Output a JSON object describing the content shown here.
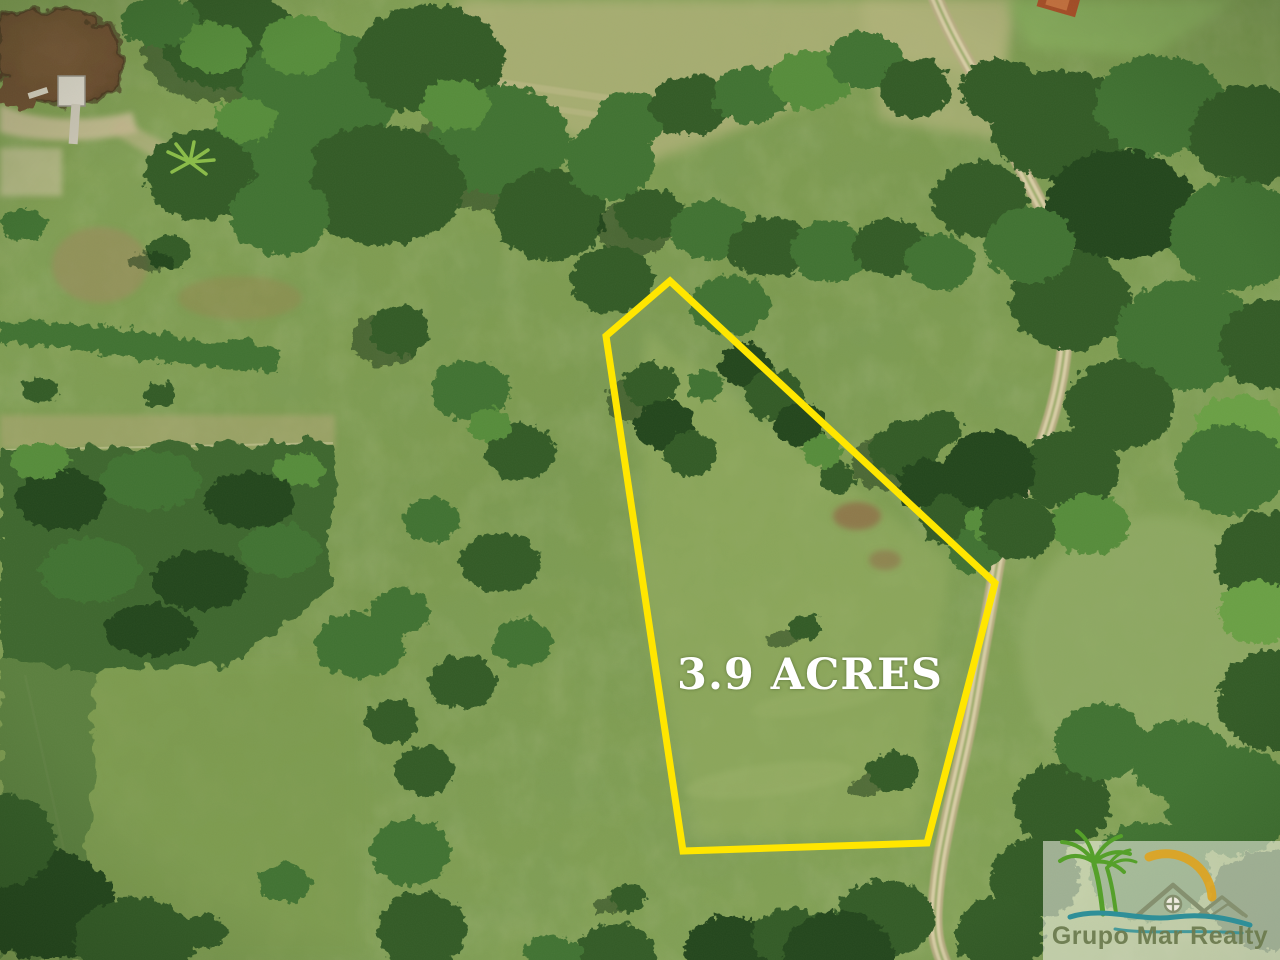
{
  "parcel": {
    "label": "3.9 ACRES",
    "label_color": "#ffffff",
    "outline_color": "#ffe600",
    "points": "670,281 995,583 927,843 683,851 606,336"
  },
  "brand": {
    "name": "Grupo Mar Realty",
    "text_color": "#6d7c50",
    "panel_color": "rgba(248,246,236,0.55)",
    "palm_color": "#55a02a",
    "sun_color": "#dfa31e",
    "house_color": "#85906f",
    "wave_color": "#2f8f98"
  }
}
